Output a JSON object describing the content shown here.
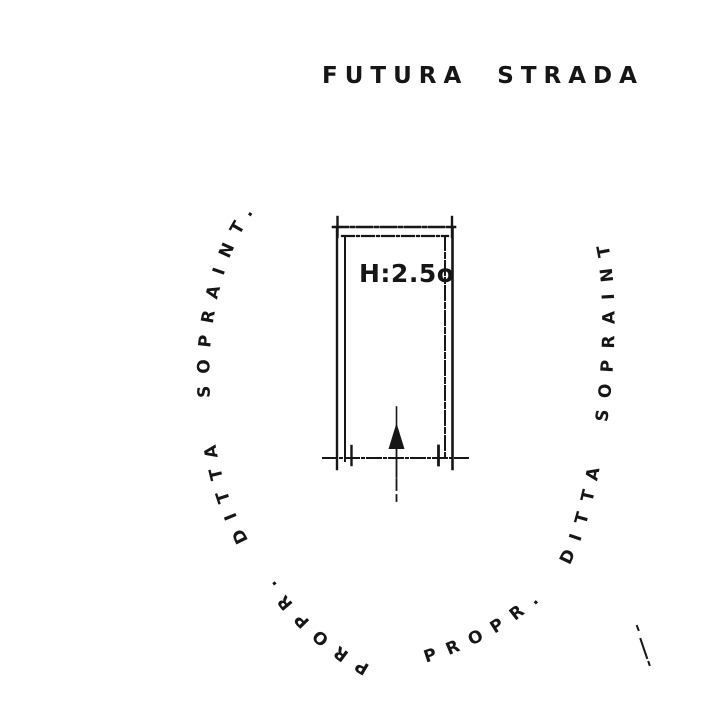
{
  "plan": {
    "street_label": "FUTURA STRADA",
    "gate": {
      "height_label": "H:2.5o"
    },
    "boundaries": {
      "left_label": "PROPR. DITTA SOPRAINT.",
      "right_label": "PROPR. DITTA SOPRAINT."
    },
    "colors": {
      "ink": "#161616",
      "paper": "#ffffff"
    }
  }
}
